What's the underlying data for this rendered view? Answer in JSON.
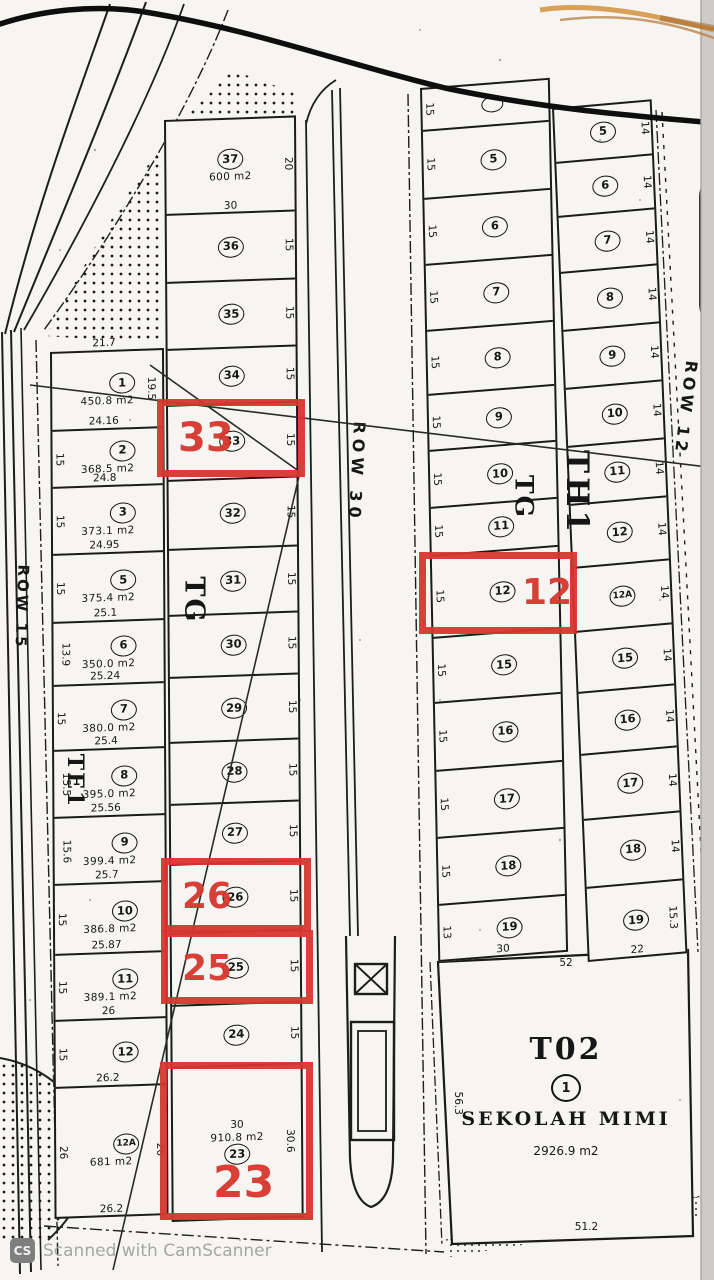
{
  "scan": {
    "watermark_badge": "CS",
    "watermark_text": "Scanned with CamScanner"
  },
  "highlight_color": "#d6362e",
  "roads": [
    {
      "id": "row15",
      "label": "ROW 15"
    },
    {
      "id": "row30",
      "label": "ROW 30"
    },
    {
      "id": "row12",
      "label": "ROW 12"
    }
  ],
  "block_labels": [
    {
      "id": "te1",
      "text": "TE1"
    },
    {
      "id": "tg_west",
      "text": "TG"
    },
    {
      "id": "tg_east",
      "text": "TG"
    },
    {
      "id": "th1",
      "text": "TH1"
    }
  ],
  "highlights": [
    {
      "plot": "33"
    },
    {
      "plot": "12"
    },
    {
      "plot": "26"
    },
    {
      "plot": "25"
    },
    {
      "plot": "23"
    }
  ],
  "columns": [
    {
      "id": "col1",
      "plots": [
        {
          "no": "1",
          "top": "21.7",
          "area": "450.8 m2",
          "right": "19.5"
        },
        {
          "no": "2",
          "top": "24.16",
          "area": "368.5 m2",
          "left": "15"
        },
        {
          "no": "3",
          "top": "24.8",
          "area": "373.1 m2",
          "left": "15"
        },
        {
          "no": "5",
          "top": "24.95",
          "area": "375.4 m2",
          "left": "15"
        },
        {
          "no": "6",
          "top": "25.1",
          "area": "350.0 m2",
          "left": "13.9"
        },
        {
          "no": "7",
          "top": "25.24",
          "area": "380.0 m2",
          "left": "15"
        },
        {
          "no": "8",
          "top": "25.4",
          "area": "395.0 m2",
          "left": "15.5"
        },
        {
          "no": "9",
          "top": "25.56",
          "area": "399.4 m2",
          "left": "15.6"
        },
        {
          "no": "10",
          "top": "25.7",
          "area": "386.8 m2",
          "left": "15"
        },
        {
          "no": "11",
          "top": "25.87",
          "area": "389.1 m2",
          "left": "15"
        },
        {
          "no": "12",
          "top": "26",
          "left": "15"
        },
        {
          "no": "12A",
          "top": "26.2",
          "area": "681 m2",
          "left": "26",
          "right": "26",
          "bottom": "26.2"
        }
      ]
    },
    {
      "id": "col2",
      "plots": [
        {
          "no": "37",
          "area": "600 m2",
          "bottom": "30",
          "right": "20"
        },
        {
          "no": "36",
          "right": "15"
        },
        {
          "no": "35",
          "right": "15"
        },
        {
          "no": "34",
          "right": "15"
        },
        {
          "no": "33",
          "right": "15"
        },
        {
          "no": "32",
          "right": "15"
        },
        {
          "no": "31",
          "right": "15"
        },
        {
          "no": "30",
          "right": "15"
        },
        {
          "no": "29",
          "right": "15"
        },
        {
          "no": "28",
          "right": "15"
        },
        {
          "no": "27",
          "right": "15"
        },
        {
          "no": "26",
          "right": "15"
        },
        {
          "no": "25",
          "right": "15"
        },
        {
          "no": "24",
          "right": "15"
        },
        {
          "no": "23",
          "top_inner": "30",
          "area": "910.8 m2",
          "right": "30.6"
        }
      ]
    },
    {
      "id": "col3",
      "plots": [
        {
          "no": "",
          "left": "15"
        },
        {
          "no": "5",
          "left": "15"
        },
        {
          "no": "6",
          "left": "15"
        },
        {
          "no": "7",
          "left": "15"
        },
        {
          "no": "8",
          "left": "15"
        },
        {
          "no": "9",
          "left": "15"
        },
        {
          "no": "10",
          "left": "15"
        },
        {
          "no": "11",
          "left": "15"
        },
        {
          "no": "12",
          "left": "15"
        },
        {
          "no": "15",
          "left": "15"
        },
        {
          "no": "16",
          "left": "15"
        },
        {
          "no": "17",
          "left": "15"
        },
        {
          "no": "18",
          "left": "15"
        },
        {
          "no": "19",
          "left": "13",
          "bottom": "30"
        }
      ]
    },
    {
      "id": "col4",
      "plots": [
        {
          "no": "5",
          "right": "14"
        },
        {
          "no": "6",
          "right": "14"
        },
        {
          "no": "7",
          "right": "14"
        },
        {
          "no": "8",
          "right": "14"
        },
        {
          "no": "9",
          "right": "14"
        },
        {
          "no": "10",
          "right": "14"
        },
        {
          "no": "11",
          "right": "14"
        },
        {
          "no": "12",
          "right": "14"
        },
        {
          "no": "12A",
          "right": "14"
        },
        {
          "no": "15",
          "right": "14"
        },
        {
          "no": "16",
          "right": "14"
        },
        {
          "no": "17",
          "right": "14"
        },
        {
          "no": "18",
          "right": "14"
        },
        {
          "no": "19",
          "right": "15.3",
          "bottom": "22"
        }
      ]
    },
    {
      "id": "school_col",
      "plots": []
    }
  ],
  "school": {
    "block": "T02",
    "no": "1",
    "name": "SEKOLAH MIMI",
    "area": "2926.9 m2",
    "top_dim": "52",
    "left_dim": "56.3",
    "bottom_dim": "51.2"
  }
}
